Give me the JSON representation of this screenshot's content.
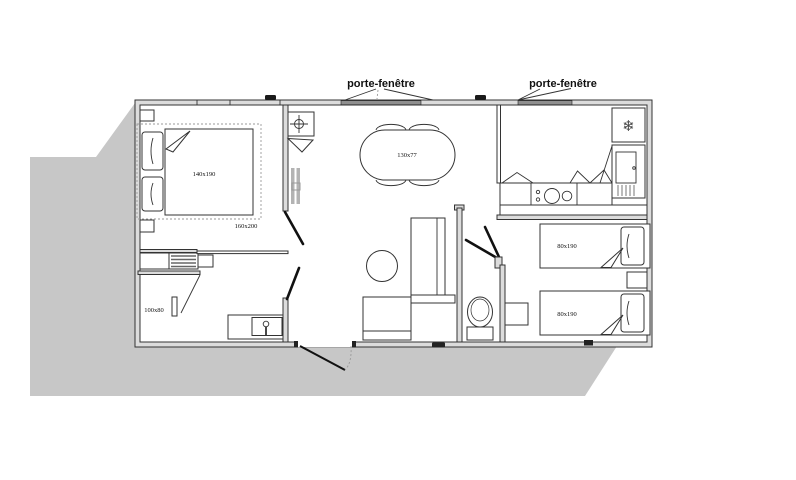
{
  "plan": {
    "labels": {
      "porte_fenetre_left": "porte-fenêtre",
      "porte_fenetre_right": "porte-fenêtre"
    },
    "dimensions": {
      "master_bed": "140x190",
      "master_room": "160x200",
      "shower": "100x80",
      "dining_table": "130x77",
      "twin_bed_top": "80x190",
      "twin_bed_bottom": "80x190"
    },
    "icons": {
      "fridge_snowflake": "❄",
      "ceiling_light": "crosshair-icon",
      "basin_tap": "faucet-icon"
    },
    "colors": {
      "shadow": "#c7c7c7",
      "wall_fill": "#dcdcdc",
      "line": "#333333",
      "door_panel": "#8f8f8f"
    }
  }
}
